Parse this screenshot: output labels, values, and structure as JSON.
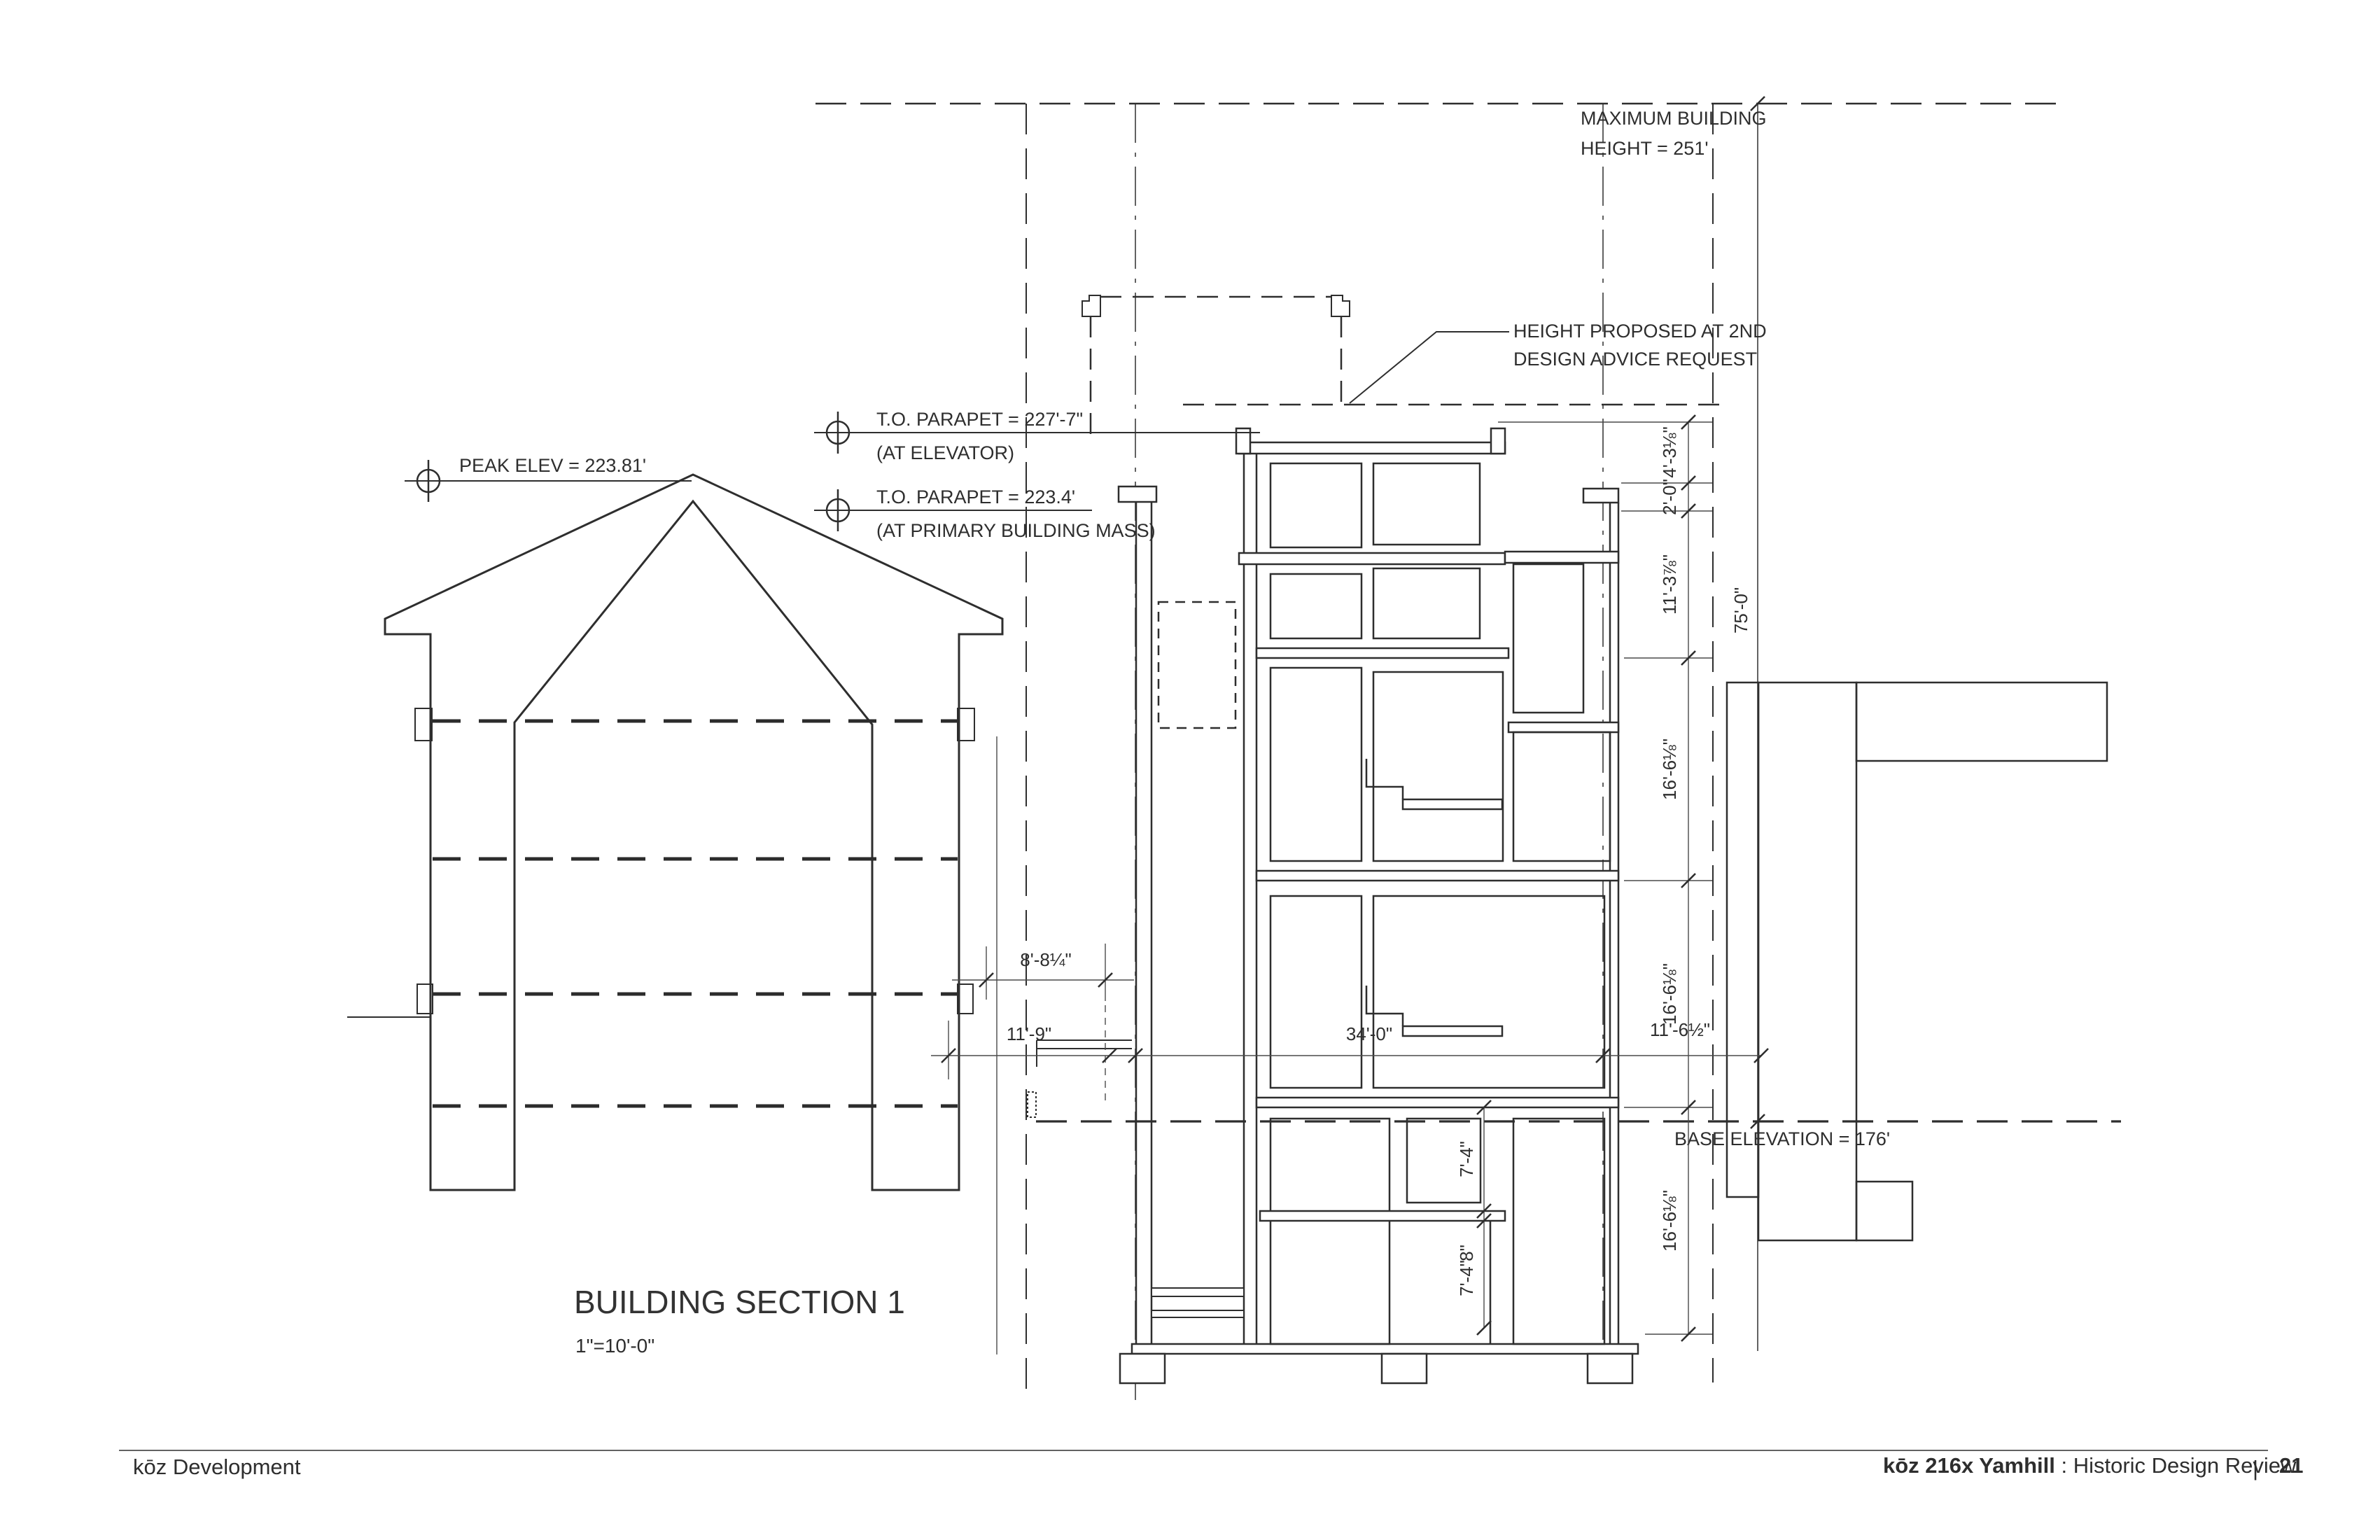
{
  "drawing": {
    "title": "BUILDING SECTION 1",
    "scale": "1\"=10'-0\"",
    "labels": {
      "max_building_height": [
        "MAXIMUM BUILDING",
        "HEIGHT = 251'"
      ],
      "height_proposed": [
        "HEIGHT PROPOSED AT 2ND",
        "DESIGN ADVICE REQUEST"
      ],
      "parapet_elevator": [
        "T.O. PARAPET = 227'-7\"",
        "(AT ELEVATOR)"
      ],
      "parapet_primary": [
        "T.O. PARAPET = 223.4'",
        "(AT PRIMARY BUILDING MASS)"
      ],
      "peak_elev": "PEAK ELEV = 223.81'",
      "base_elevation": "BASE ELEVATION = 176'"
    },
    "dims": {
      "right_chain": [
        "4'-3⅛\"",
        "2'-0\"",
        "11'-3⅞\"",
        "16'-6⅛\"",
        "16'-6⅛\"",
        "16'-6⅛\""
      ],
      "site_height": "75'-0\"",
      "h_upper": "8'-8¼\"",
      "h_left": "11'-9\"",
      "h_mid": "34'-0\"",
      "h_right": "11'-6½\"",
      "lower_chain": [
        "7'-4\"",
        "8\"",
        "7'-4\""
      ]
    }
  },
  "footer": {
    "left": "kōz Development",
    "right_project": "kōz 216x Yamhill",
    "right_suffix": " : Historic Design Review",
    "divider": "|",
    "page": "21"
  }
}
